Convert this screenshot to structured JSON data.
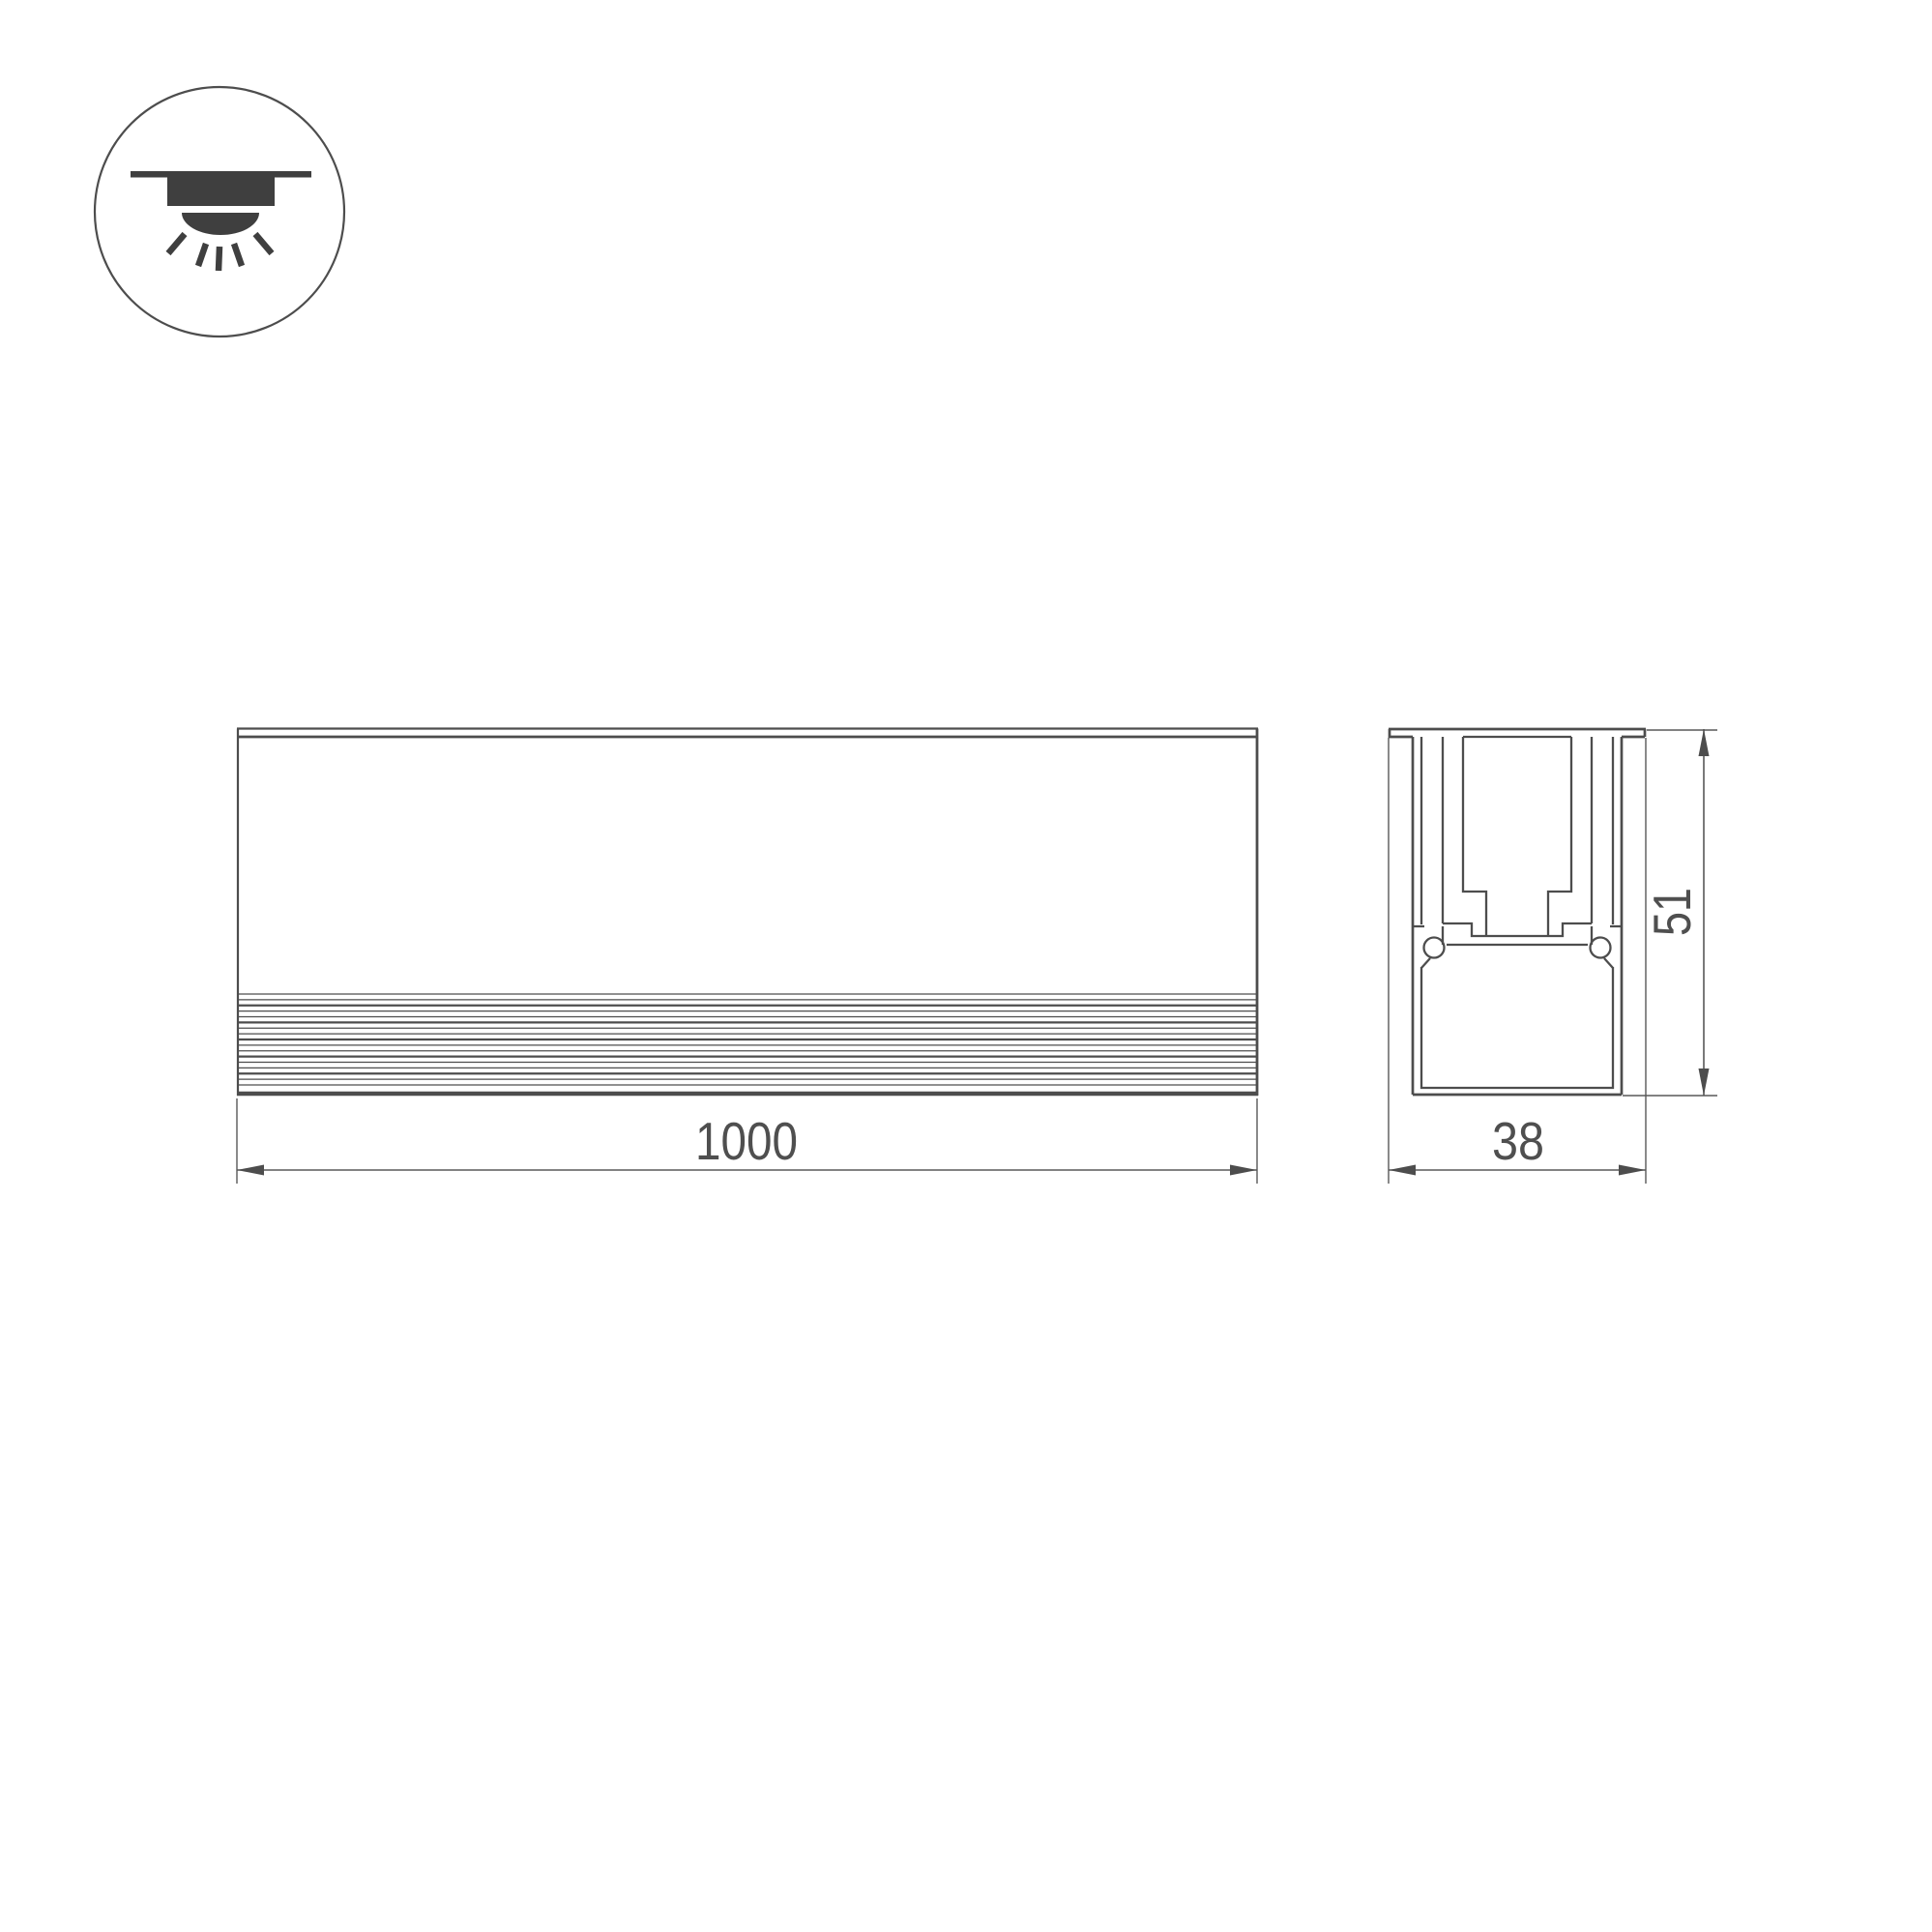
{
  "drawing": {
    "title": "recessed-linear-luminaire-technical-drawing",
    "views": {
      "front_view": "side-elevation-of-linear-profile",
      "section_view": "cross-section-of-profile"
    },
    "dimensions": {
      "length": "1000",
      "width": "38",
      "height": "51"
    }
  },
  "icons": {
    "mount_icon": "recessed-downlight-icon"
  },
  "colors": {
    "background": "#ffffff",
    "line": "#4d4d4d",
    "thin_line": "#585858",
    "icon_fill": "#3f3f3f",
    "text": "#4f4f4f"
  }
}
